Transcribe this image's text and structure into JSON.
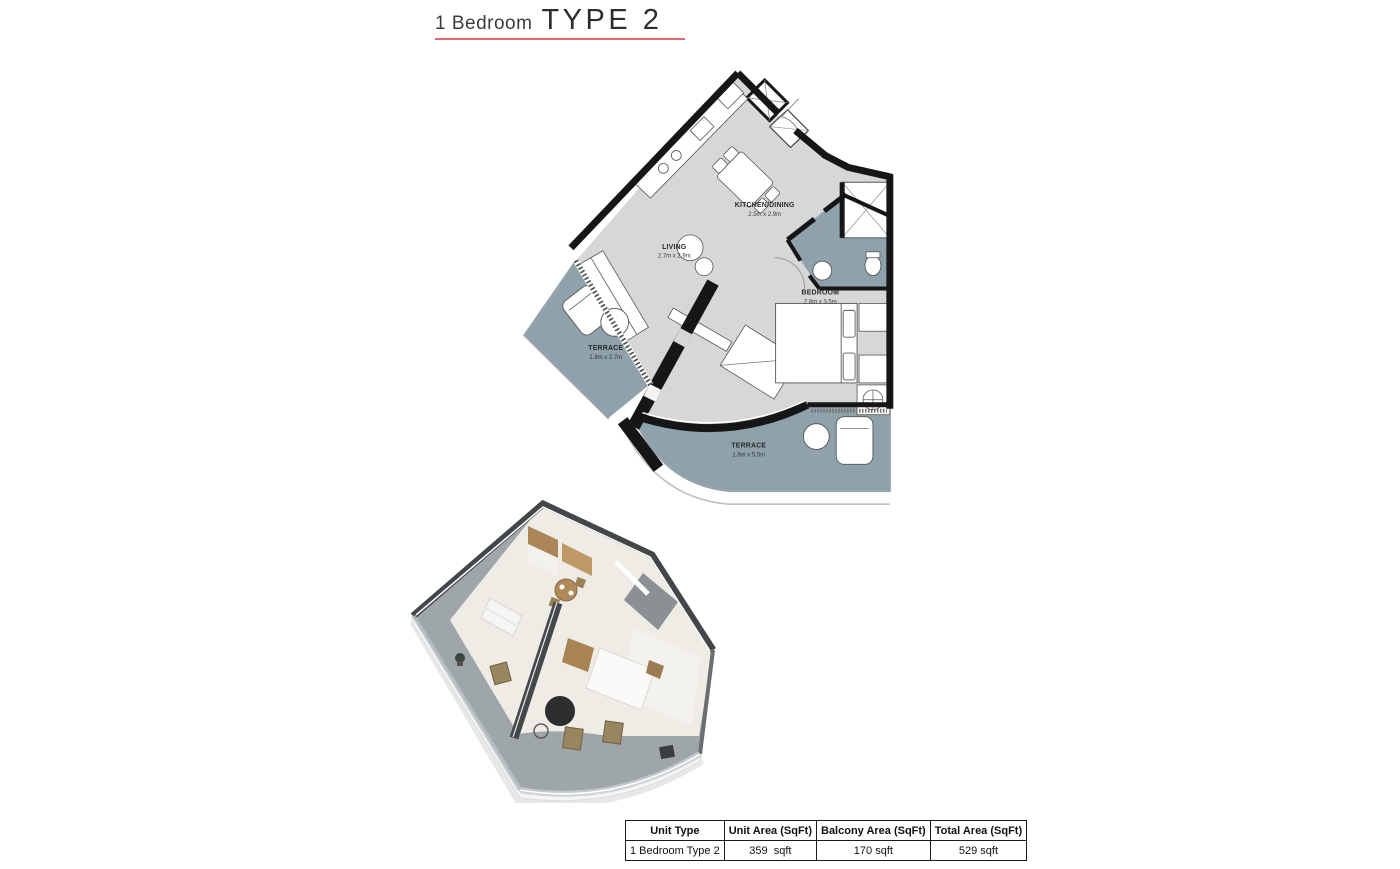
{
  "header": {
    "title_prefix": "1 Bedroom",
    "title_type": "TYPE 2"
  },
  "floorplan": {
    "rooms": {
      "kitchen": {
        "name": "KITCHEN/DINING",
        "dims": "2.5m x 2.9m"
      },
      "living": {
        "name": "LIVING",
        "dims": "2.7m x 2.9m"
      },
      "bedroom": {
        "name": "BEDROOM",
        "dims": "2.8m x 3.5m"
      },
      "terrace_side": {
        "name": "TERRACE",
        "dims": "1.8m x 2.7m"
      },
      "terrace_main": {
        "name": "TERRACE",
        "dims": "1.8m x 5.5m"
      }
    },
    "colors": {
      "wall": "#161616",
      "interior_floor": "#d5d7d8",
      "terrace_floor": "#8fa1ab",
      "accent_underline": "#e06a6e"
    }
  },
  "area_table": {
    "headers": [
      "Unit Type",
      "Unit Area (SqFt)",
      "Balcony Area (SqFt)",
      "Total Area (SqFt)"
    ],
    "row": [
      "1 Bedroom Type 2",
      "359  sqft",
      "170 sqft",
      "529 sqft"
    ]
  }
}
